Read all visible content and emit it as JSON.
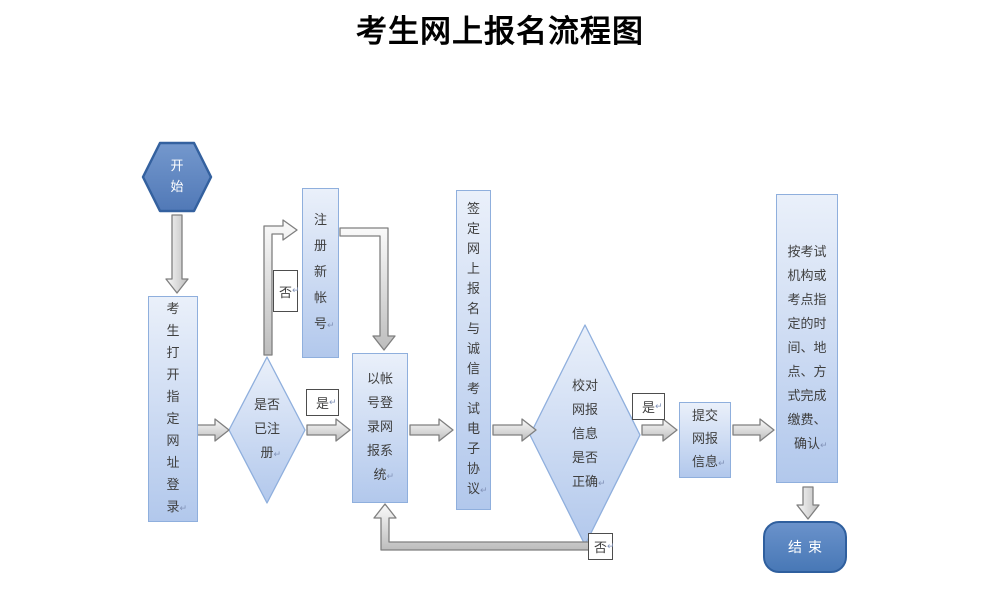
{
  "title": "考生网上报名流程图",
  "marks": {
    "return": "↵"
  },
  "nodes": {
    "start": {
      "label": "开始"
    },
    "open_site": {
      "label": "考生打开指定网址登录"
    },
    "is_registered": {
      "label": "是否已注册"
    },
    "register_new": {
      "label": "注册新帐号"
    },
    "login_system": {
      "label": "以帐号登录网报系统"
    },
    "sign_agreement": {
      "label": "签定网上报名与诚信考试电子协议"
    },
    "check_info": {
      "label": "校对网报信息是否正确"
    },
    "submit_info": {
      "label": "提交网报信息"
    },
    "pay_confirm": {
      "label": "按考试机构或考点指定的时间、地点、方式完成缴费、确认"
    },
    "end": {
      "label": "结束"
    }
  },
  "edge_labels": {
    "registered_yes": "是",
    "registered_no": "否",
    "check_yes": "是",
    "check_no": "否"
  },
  "colors": {
    "node_fill_light_top": "#eaf0fa",
    "node_fill_light_bottom": "#b2c8ec",
    "node_border_light": "#8fafdd",
    "node_fill_dark": "#5b85c3",
    "node_border_dark": "#2f5f9e",
    "arrow_fill_light": "#fafafa",
    "arrow_fill_dark": "#bfbfbf",
    "arrow_border": "#7f7f7f",
    "label_border": "#4d4d4d",
    "text": "#3f3f3f",
    "title_text": "#000000"
  }
}
